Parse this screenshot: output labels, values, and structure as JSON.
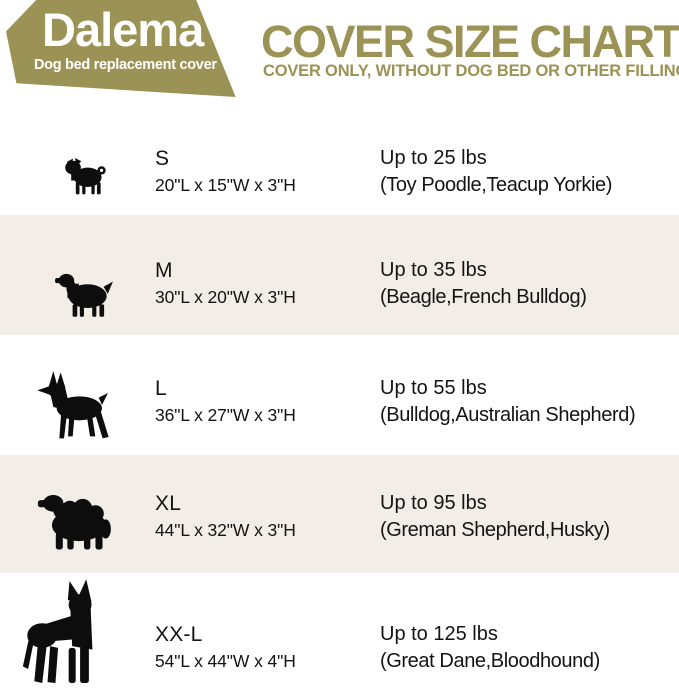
{
  "brand": {
    "name": "Dalema",
    "tagline": "Dog bed replacement cover"
  },
  "header": {
    "title": "COVER SIZE CHART",
    "subtitle": "COVER ONLY, WITHOUT DOG BED OR OTHER FILLINGS"
  },
  "colors": {
    "olive_accent": "#9b9355",
    "row_alt_background": "#f2ede7",
    "text": "#141414",
    "logo_text": "#ffffff"
  },
  "rows": [
    {
      "size": "S",
      "dimensions": "20\"L x 15\"W x 3\"H",
      "weight": "Up to 25 lbs",
      "breeds": "(Toy Poodle,Teacup Yorkie)",
      "icon": "pug-silhouette"
    },
    {
      "size": "M",
      "dimensions": "30\"L x 20\"W x 3\"H",
      "weight": "Up to 35 lbs",
      "breeds": "(Beagle,French Bulldog)",
      "icon": "cocker-spaniel-silhouette"
    },
    {
      "size": "L",
      "dimensions": "36\"L x 27\"W x 3\"H",
      "weight": "Up to 55 lbs",
      "breeds": "(Bulldog,Australian Shepherd)",
      "icon": "doberman-silhouette"
    },
    {
      "size": "XL",
      "dimensions": "44\"L x 32\"W x 3\"H",
      "weight": "Up to 95 lbs",
      "breeds": "(Greman Shepherd,Husky)",
      "icon": "mountain-dog-silhouette"
    },
    {
      "size": "XX-L",
      "dimensions": "54\"L x 44\"W x 4\"H",
      "weight": "Up to 125 lbs",
      "breeds": "(Great Dane,Bloodhound)",
      "icon": "great-dane-silhouette"
    }
  ],
  "chart_data": {
    "type": "table",
    "title": "COVER SIZE CHART",
    "subtitle": "COVER ONLY, WITHOUT DOG BED OR OTHER FILLINGS",
    "columns": [
      "Size",
      "Cover Dimensions",
      "Recommended Weight",
      "Example Breeds"
    ],
    "rows": [
      [
        "S",
        "20\"L x 15\"W x 3\"H",
        "Up to 25 lbs",
        "Toy Poodle, Teacup Yorkie"
      ],
      [
        "M",
        "30\"L x 20\"W x 3\"H",
        "Up to 35 lbs",
        "Beagle, French Bulldog"
      ],
      [
        "L",
        "36\"L x 27\"W x 3\"H",
        "Up to 55 lbs",
        "Bulldog, Australian Shepherd"
      ],
      [
        "XL",
        "44\"L x 32\"W x 3\"H",
        "Up to 95 lbs",
        "Greman Shepherd, Husky"
      ],
      [
        "XX-L",
        "54\"L x 44\"W x 4\"H",
        "Up to 125 lbs",
        "Great Dane, Bloodhound"
      ]
    ]
  }
}
